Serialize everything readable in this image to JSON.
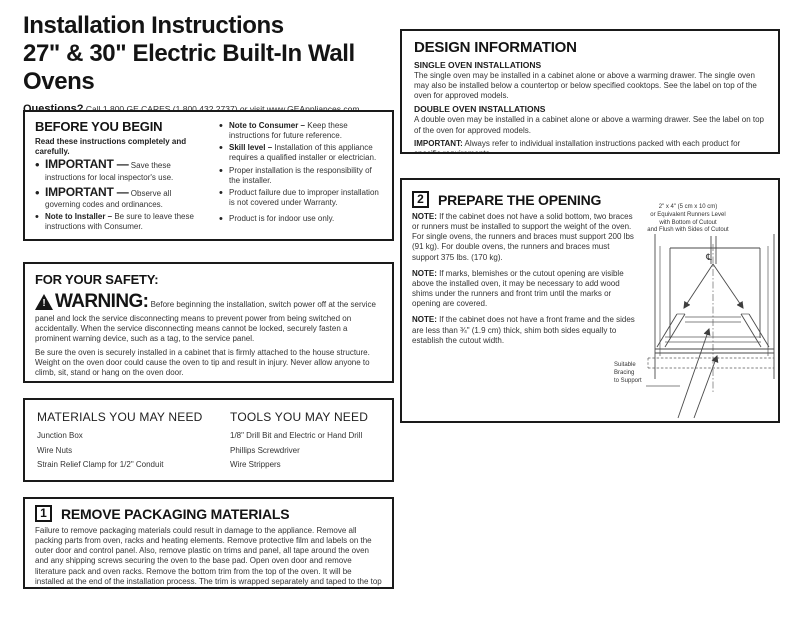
{
  "page": {
    "title_line1": "Installation Instructions",
    "title_line2": "27\" & 30\" Electric Built-In Wall Ovens",
    "questions_label": "Questions?",
    "questions_text": " Call 1.800.GE.CARES (1.800.432.2737) or visit www.GEAppliances.com",
    "canada_line": "In Canada, call 1.800.561.3344 or visit www.GEAppliances.ca"
  },
  "before_you_begin": {
    "heading": "BEFORE YOU BEGIN",
    "intro": "Read these instructions completely and carefully.",
    "left_bullets": [
      {
        "lead": "IMPORTANT —",
        "text": " Save these instructions for local inspector's use."
      },
      {
        "lead": "IMPORTANT —",
        "text": " Observe all governing codes and ordinances."
      },
      {
        "lead": "Note to Installer –",
        "text": " Be sure to leave these instructions with Consumer."
      }
    ],
    "right_bullets": [
      {
        "lead": "Note to Consumer –",
        "text": " Keep these instructions for future reference."
      },
      {
        "lead": "Skill level –",
        "text": " Installation of this appliance requires a qualified installer or electrician."
      },
      {
        "lead": "",
        "text": "Proper installation is the responsibility of the installer."
      },
      {
        "lead": "",
        "text": "Product failure due to improper installation is not covered under Warranty."
      },
      {
        "lead": "",
        "text": "Product is for indoor use only."
      }
    ],
    "attention_lead": "ATTENTION INSTALLER:",
    "attention_text": " All electric wall ovens must be hard-wired (direct-wired) into an approved junction box. A plug and receptacle is NOT permitted on these products."
  },
  "safety": {
    "heading": "FOR YOUR SAFETY:",
    "warning_word": "WARNING:",
    "warning_text": " Before beginning the installation, switch power off at the service panel and lock the service disconnecting means to prevent power from being switched on accidentally. When the service disconnecting means cannot be locked, securely fasten a prominent warning device, such as a tag, to the service panel.",
    "para2": "Be sure the oven is securely installed in a cabinet that is firmly attached to the house structure. Weight on the oven door could cause the oven to tip and result in injury. Never allow anyone to climb, sit, stand or hang on the oven door.",
    "para3": "Make sure the wall coverings, counters and cabinets around the oven can withstand the heat (up to 200°F [93.3°C]) generated by the oven."
  },
  "materials": {
    "heading": "MATERIALS YOU MAY NEED",
    "items": [
      "Junction Box",
      "Wire Nuts",
      "Strain Relief Clamp for 1/2\" Conduit"
    ]
  },
  "tools": {
    "heading": "TOOLS YOU MAY NEED",
    "items": [
      "1/8\" Drill Bit and Electric or Hand Drill",
      "Phillips Screwdriver",
      "Wire Strippers"
    ]
  },
  "step1": {
    "number": "1",
    "heading": "REMOVE PACKAGING MATERIALS",
    "body": "Failure to remove packaging materials could result in damage to the appliance. Remove all packing parts from oven, racks and heating elements. Remove protective film and labels on the outer door and control panel. Also, remove plastic on trims and panel, all tape around the oven and any shipping screws securing the oven to the base pad. Open oven door and remove literature pack and oven racks. Remove the bottom trim from the top of the oven. It will be installed at the end of the installation process. The trim is wrapped separately and taped to the top of the unit. Remove pedestal rails from seperate box and set aside (30\" Double Wall Ovens Only)."
  },
  "design_info": {
    "heading": "DESIGN INFORMATION",
    "single_heading": "SINGLE OVEN INSTALLATIONS",
    "single_text": "The single oven may be installed in a cabinet alone or above a warming drawer. The single oven may also be installed below a countertop or below specified cooktops. See the label on top of the oven for approved models.",
    "double_heading": "DOUBLE OVEN INSTALLATIONS",
    "double_text": "A double oven may be installed in a cabinet alone or above a warming drawer. See the label on top of the oven for approved models.",
    "important_lead": "IMPORTANT:",
    "important_text": " Always refer to individual installation instructions packed with each product for specific requirements."
  },
  "step2": {
    "number": "2",
    "heading": "PREPARE THE OPENING",
    "notes": [
      {
        "lead": "NOTE:",
        "text": " If the cabinet does not have a solid bottom, two braces or runners must be installed to support the weight of the oven. For single ovens, the runners and braces must support 200 lbs (91 kg). For double ovens, the runners and braces must support 375 lbs. (170 kg)."
      },
      {
        "lead": "NOTE:",
        "text": " If marks, blemishes or the cutout opening are visible above the installed oven, it may be necessary to add wood shims under the runners and front trim until the marks or opening are covered."
      },
      {
        "lead": "NOTE:",
        "text": " If the cabinet does not have a front frame and the sides are less than ¾\" (1.9 cm) thick, shim both sides equally to establish the cutout width."
      }
    ],
    "diagram": {
      "runner_label_line1": "2\" x 4\" (5 cm x 10 cm)",
      "runner_label_line2": "or Equivalent Runners Level",
      "runner_label_line3": "with Bottom of Cutout",
      "runner_label_line4": "and Flush with Sides of Cutout",
      "bracing_label_line1": "Suitable",
      "bracing_label_line2": "Bracing",
      "bracing_label_line3": "to Support",
      "centerline_symbol": "℄"
    }
  }
}
